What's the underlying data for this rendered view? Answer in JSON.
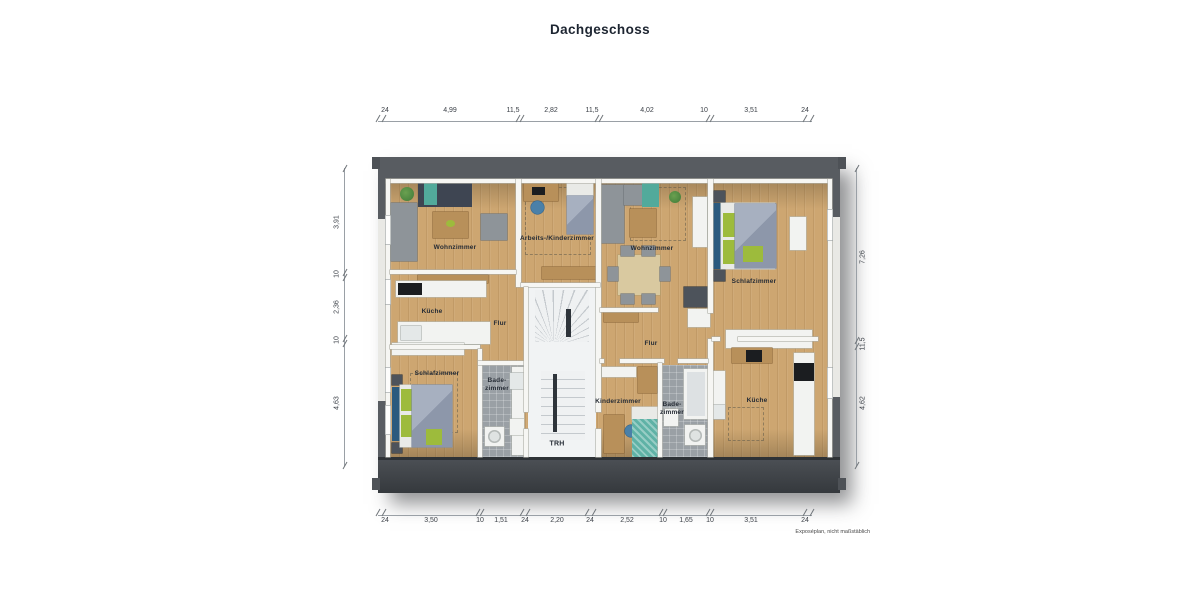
{
  "title": "Dachgeschoss",
  "footnote": "Exposéplan, nicht maßstäblich",
  "rooms": {
    "wohnzimmer_left": "Wohnzimmer",
    "arbeits_kinderzimmer": "Arbeits-/Kinderzimmer",
    "wohnzimmer_right": "Wohnzimmer",
    "schlafzimmer_right": "Schlafzimmer",
    "kueche_left": "Küche",
    "flur_left": "Flur",
    "flur_right": "Flur",
    "schlafzimmer_left": "Schlafzimmer",
    "bad_left": "Bade-\nzimmer",
    "kinderzimmer": "Kinderzimmer",
    "bad_right": "Bade-\nzimmer",
    "kueche_right": "Küche",
    "trh": "TRH"
  },
  "dimensions": {
    "top": [
      "24",
      "4,99",
      "11,5",
      "2,82",
      "11,5",
      "4,02",
      "10",
      "3,51",
      "24"
    ],
    "bottom": [
      "24",
      "3,50",
      "10",
      "1,51",
      "24",
      "2,20",
      "24",
      "2,52",
      "10",
      "1,65",
      "10",
      "3,51",
      "24"
    ],
    "left": [
      "3,91",
      "10",
      "2,36",
      "10",
      "4,63"
    ],
    "right": [
      "7,26",
      "11,5",
      "4,62"
    ]
  },
  "colors": {
    "roof": "#585c61",
    "wood_floor": "#cda671",
    "bath_tile": "#9aa0a5",
    "accent_green": "#9dbb3c",
    "accent_teal": "#52aa9b",
    "bed_blue": "#2b5a7e"
  }
}
